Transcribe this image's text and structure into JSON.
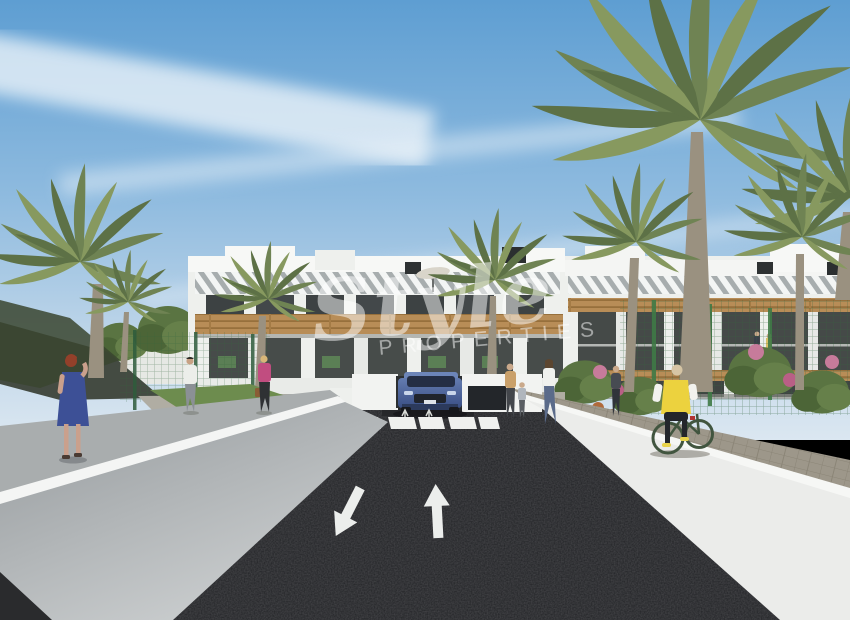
{
  "scene": {
    "kind": "3d-architectural-exterior-render",
    "subject": "New-build white apartment complex with palm trees, entrance driveway with a blue SUV, zebra crosswalk, road lane arrows, pedestrians and a cyclist",
    "watermark": {
      "script_text": "Style",
      "caps_text": "PROPERTIES"
    }
  },
  "palette": {
    "sky_top": "#5e9ed2",
    "sky_horizon": "#dbe7f1",
    "cloud_white": "#eef4f9",
    "building_white": "#f1f2ef",
    "window_dark": "#3d4243",
    "pergola_wood": "#b88d57",
    "palm_green": "#6f8353",
    "tree_green": "#5a7442",
    "fence_green": "#35663f",
    "asphalt": "#212225",
    "road_marking_white": "#edefec",
    "left_wall_gray": "#b4b8ba",
    "right_wall_white": "#ebecea",
    "paver_gray": "#9d978a",
    "car_blue": "#46608f",
    "vest_yellow": "#ecd23e",
    "dress_blue": "#3d5096",
    "top_pink": "#c14d80",
    "flower_pink": "#c77b9b"
  },
  "objects": {
    "road_markings": [
      "forward-lane-arrow",
      "oncoming-lane-arrow",
      "zebra-crosswalk"
    ],
    "vehicle": "blue SUV at entrance ramp",
    "people": [
      "woman in blue dress on left walkway",
      "man in white shirt on path",
      "woman in pink top near crosswalk",
      "woman with child at entrance",
      "woman in white top at entrance",
      "person near right building",
      "cyclist in yellow vest on right walkway",
      "two residents on right balcony"
    ]
  }
}
